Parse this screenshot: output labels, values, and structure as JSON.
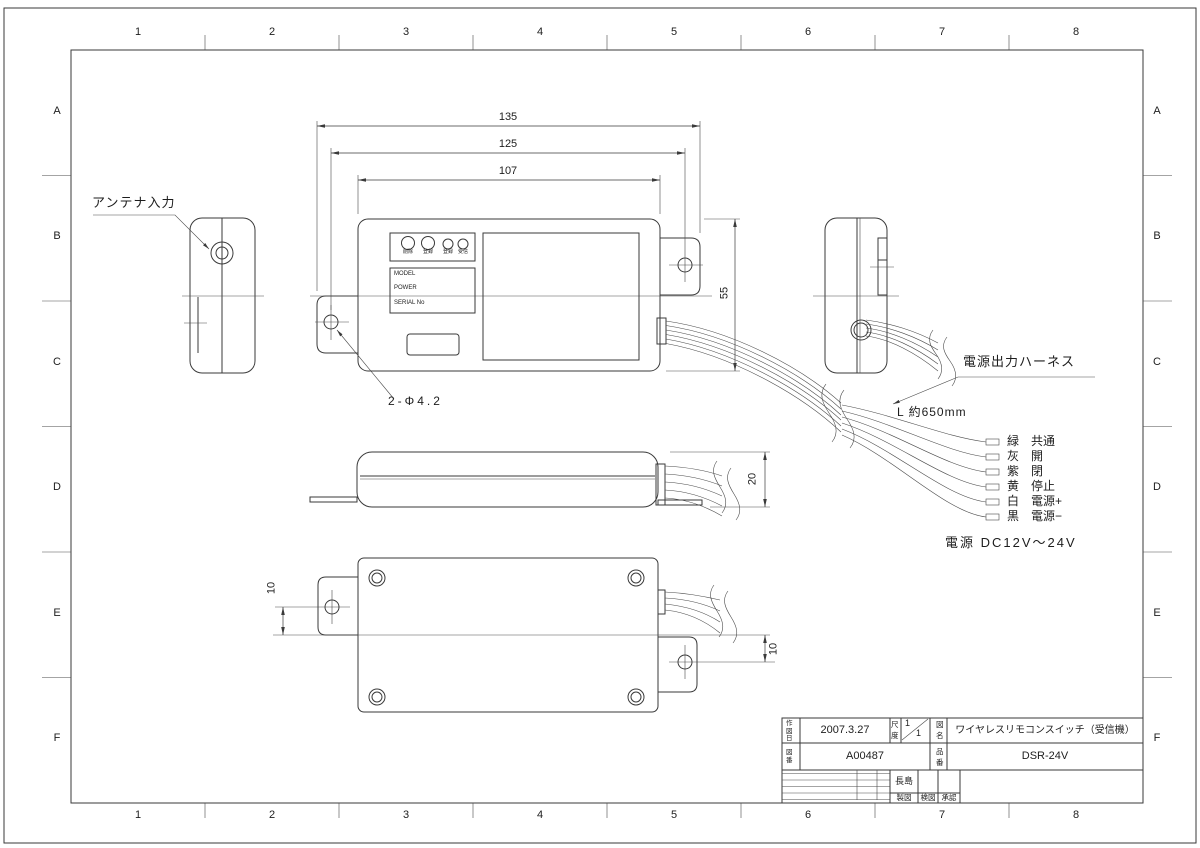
{
  "drawing": {
    "grid": {
      "cols": [
        "1",
        "2",
        "3",
        "4",
        "5",
        "6",
        "7",
        "8"
      ],
      "rows": [
        "A",
        "B",
        "C",
        "D",
        "E",
        "F"
      ]
    },
    "dims": {
      "width_overall": "135",
      "width_holes": "125",
      "width_body": "107",
      "height_body": "55",
      "thickness": "20",
      "hole_offset_left": "10",
      "hole_offset_right": "10"
    },
    "labels": {
      "antenna_input": "アンテナ入力",
      "hole_note": "2-Φ4.2",
      "harness": "電源出力ハーネス",
      "harness_length": "L 約650mm",
      "power_note": "電源 DC12V～24V"
    },
    "front_panel": {
      "buttons": [
        "削除",
        "登録",
        "登録",
        "受信"
      ],
      "nameplate": [
        "MODEL",
        "POWER",
        "SERIAL No"
      ]
    },
    "wires": [
      {
        "color_name": "緑",
        "function": "共通"
      },
      {
        "color_name": "灰",
        "function": "開"
      },
      {
        "color_name": "紫",
        "function": "閉"
      },
      {
        "color_name": "黄",
        "function": "停止"
      },
      {
        "color_name": "白",
        "function": "電源+"
      },
      {
        "color_name": "黒",
        "function": "電源−"
      }
    ],
    "title_block": {
      "date_label": "作図日",
      "date": "2007.3.27",
      "scale_label": "尺度",
      "scale_num": "1",
      "scale_den": "1",
      "name_label": "図名",
      "name": "ワイヤレスリモコンスイッチ（受信機）",
      "dwg_no_label": "図番",
      "dwg_no": "A00487",
      "part_no_label": "品番",
      "part_no": "DSR-24V",
      "drafter": "長島",
      "sign_labels": [
        "製図",
        "検図",
        "承認"
      ]
    }
  }
}
